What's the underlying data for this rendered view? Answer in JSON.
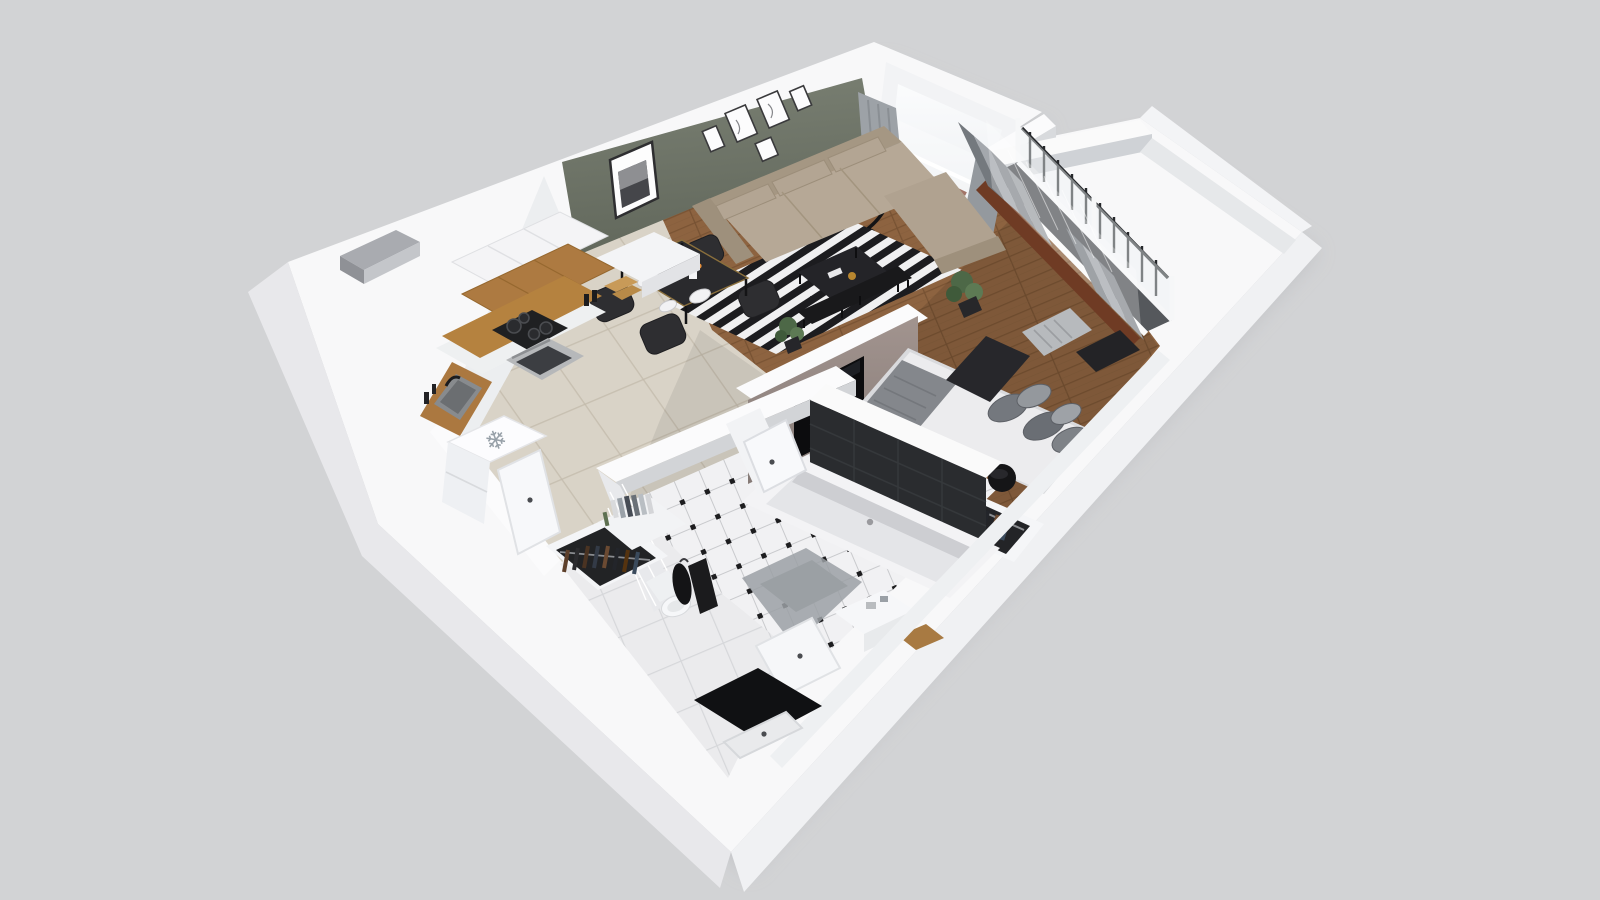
{
  "meta": {
    "title": "3D isometric cutaway floor plan of a one-bedroom apartment",
    "view": "axonometric dollhouse render",
    "background": "#d2d3d5"
  },
  "icons": {
    "snowflake_glyph": "❄"
  },
  "palette": {
    "background": "#d2d3d5",
    "wall_top": "#f8f8f9",
    "wall_face_light": "#eceef0",
    "wall_face_shade": "#d8dadd",
    "accent_olive_wall": "#6d7366",
    "partition_taupe": "#968a86",
    "tv_black": "#0c0c0e",
    "wood_floor": "#8d6340",
    "wood_seam": "#7a5434",
    "beige_tile": "#d9d3c7",
    "beige_tile_line": "#c3bbac",
    "rug_black": "#1c1c1f",
    "rug_white": "#f0f0f1",
    "sofa_beige": "#b6a896",
    "counter_wood": "#b5823f",
    "cabinet_wood": "#ad7a41",
    "bath_dark_tile": "#2a2c2f",
    "bath_floor_tile": "#f1f1f3",
    "bath_floor_dot": "#1d1d1f",
    "curtain_gray": "#9da2a7",
    "bed_sheet": "#ececee",
    "bed_runner": "#27272b",
    "blanket_gray": "#84878c",
    "plant_green": "#4d6847",
    "mat_black": "#101113"
  },
  "rooms": {
    "living_room": {
      "label": "Living room",
      "furniture": [
        "corner sofa",
        "striped rug",
        "coffee table",
        "media console",
        "floor lamp",
        "gallery wall frames",
        "large picture frame",
        "window with curtains",
        "plant"
      ]
    },
    "kitchen": {
      "label": "Kitchen",
      "furniture": [
        "upper cabinets",
        "wood cabinet band",
        "countertop",
        "cooktop",
        "oven",
        "sink",
        "refrigerator",
        "open door",
        "vent shaft"
      ]
    },
    "dining_area": {
      "label": "Dining area",
      "furniture": [
        "dining table",
        "four chairs",
        "plates",
        "wine bottle",
        "orange flowers"
      ]
    },
    "bedroom": {
      "label": "Bedroom",
      "furniture": [
        "double bed",
        "gray pillows",
        "dark runner",
        "throw blanket",
        "round pouf",
        "open wardrobe with clothes",
        "balcony glazing with railing",
        "curtains",
        "radiator",
        "wood sill",
        "plant"
      ]
    },
    "bathroom": {
      "label": "Bathroom",
      "furniture": [
        "bathtub",
        "dark tile wall",
        "diamond tile floor",
        "toilet",
        "towel",
        "bath mat",
        "vanity sink",
        "wooden stool",
        "door"
      ]
    },
    "hallway": {
      "label": "Hallway / entry",
      "furniture": [
        "open closet with clothes",
        "book shelf",
        "hanging coat",
        "black entry mat",
        "entry door",
        "white tile floor"
      ]
    }
  }
}
